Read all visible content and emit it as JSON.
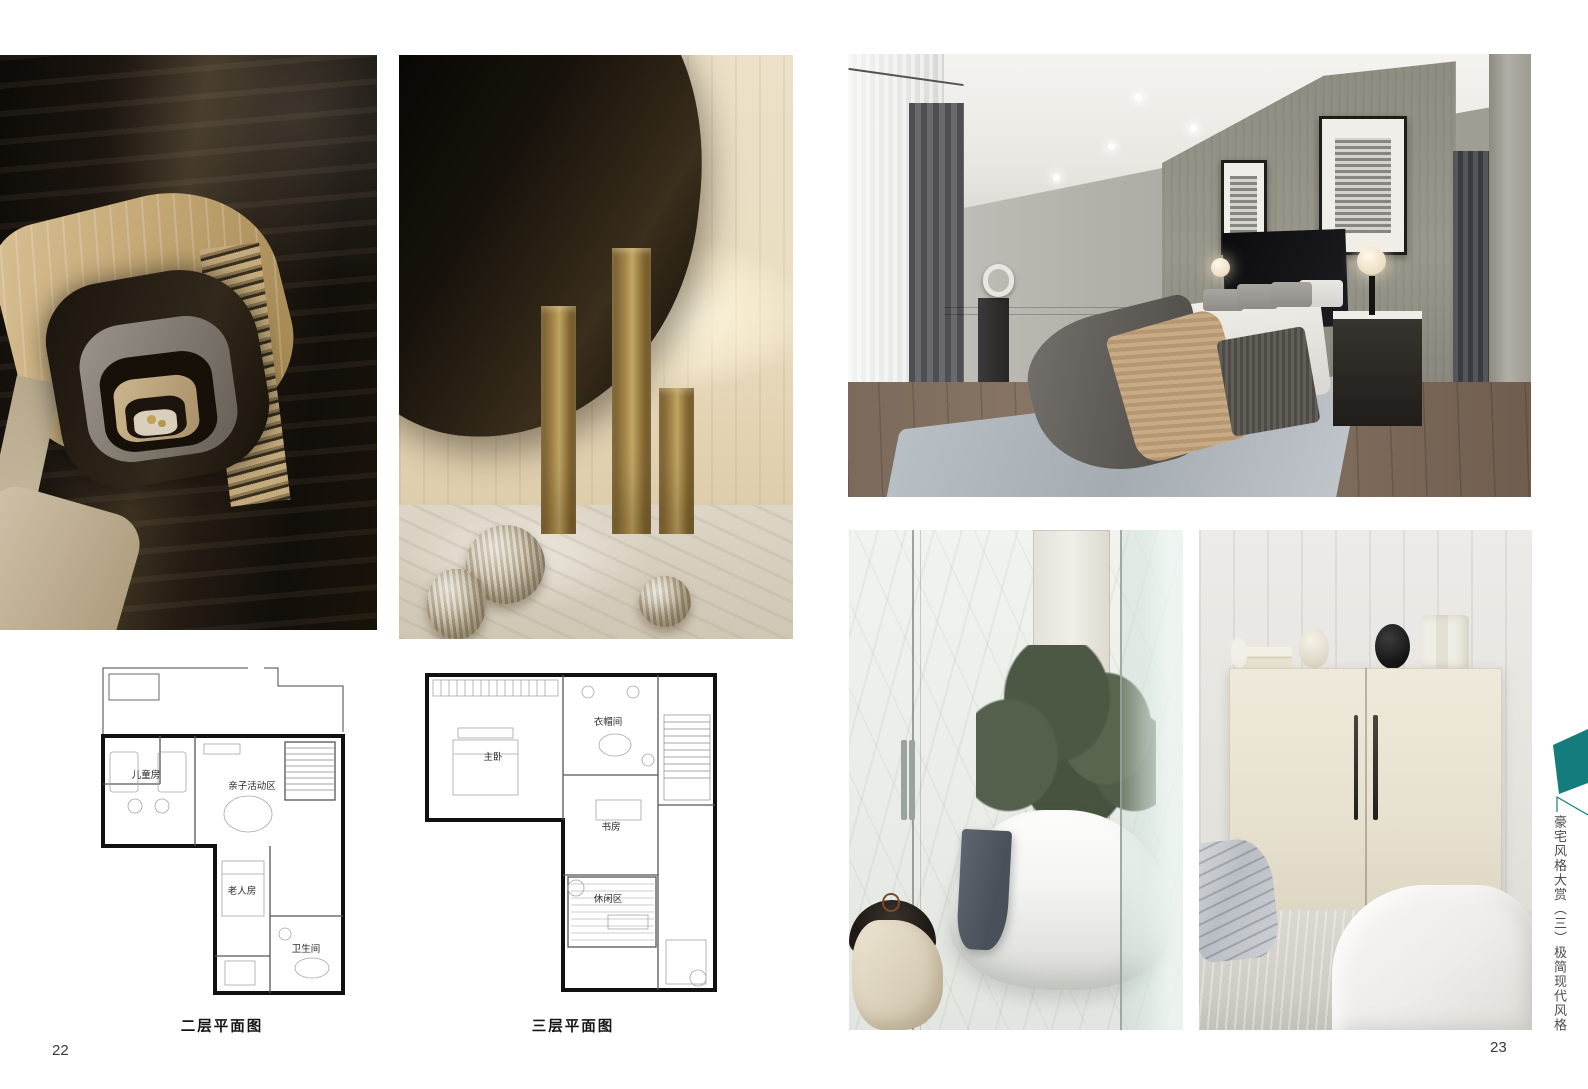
{
  "left_page": {
    "page_number": "22",
    "floor_plans": [
      {
        "caption": "二层平面图",
        "rooms": [
          "儿童房",
          "亲子活动区",
          "老人房",
          "卫生间"
        ]
      },
      {
        "caption": "三层平面图",
        "rooms": [
          "主卧",
          "衣帽间",
          "书房",
          "休闲区"
        ]
      }
    ]
  },
  "right_page": {
    "page_number": "23",
    "side_tab": {
      "series_title": "豪宅风格大赏",
      "volume_marker": "（三）",
      "chapter_title": "极简现代风格",
      "flag_color": "#157c7d"
    }
  }
}
